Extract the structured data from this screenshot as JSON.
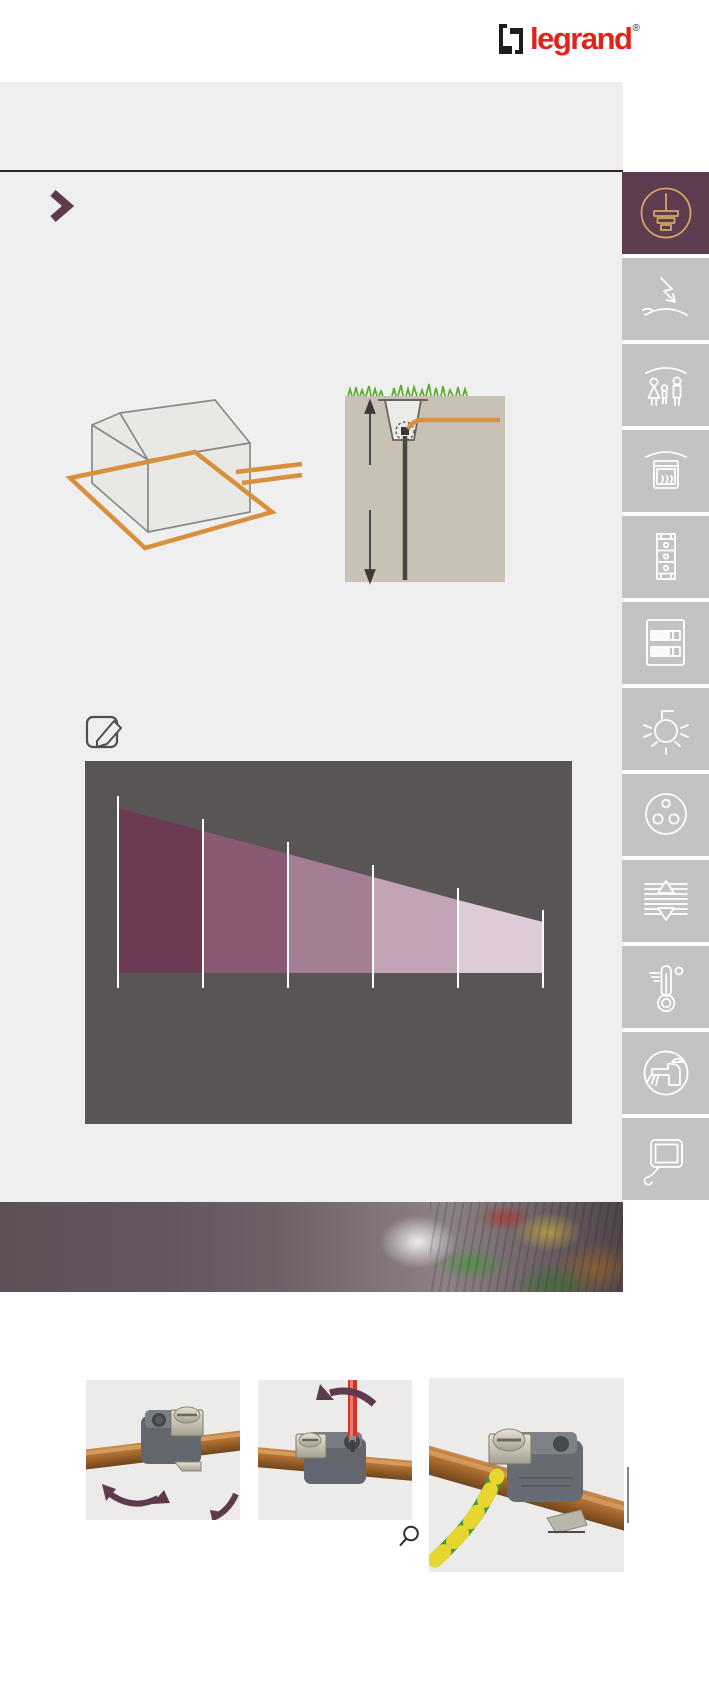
{
  "header": {
    "logo_text": "legrand",
    "registered_mark": "®",
    "brand_red": "#e2231a",
    "logo_mark_color": "#1d1d1b"
  },
  "layout_colors": {
    "page_background": "#ffffff",
    "content_background": "#efefef",
    "rule_color": "#2b242b",
    "section_chevron_color": "#5e3a4d"
  },
  "sidebar": {
    "active_index": 0,
    "active_tile_color": "#5c3c4e",
    "active_icon_color": "#d4a567",
    "tile_color": "#c3c3c3",
    "icon_color": "#ffffff",
    "items": [
      {
        "icon": "earth-ground-icon"
      },
      {
        "icon": "lightning-surge-icon"
      },
      {
        "icon": "family-protection-icon"
      },
      {
        "icon": "oven-cooking-icon"
      },
      {
        "icon": "distribution-column-icon"
      },
      {
        "icon": "consumer-unit-icon"
      },
      {
        "icon": "energy-saving-lamp-icon"
      },
      {
        "icon": "power-socket-icon"
      },
      {
        "icon": "roller-shutter-icon"
      },
      {
        "icon": "thermometer-icon"
      },
      {
        "icon": "water-tap-icon"
      },
      {
        "icon": "monitor-icon"
      }
    ]
  },
  "illustrations": {
    "house_earth_loop": {
      "loop_color": "#d8903f",
      "house_outline_color": "#8a8a8a",
      "house_fill_color": "#e9e8e4"
    },
    "earth_rod_trench": {
      "soil_color": "#c8c1b6",
      "grass_color": "#5aac2e",
      "conductor_color": "#d8903f",
      "rod_color": "#4c4543",
      "arrow_color": "#3c3a38"
    },
    "notes_icon": "pencil-edit-icon"
  },
  "chart_data": {
    "type": "area",
    "title": "",
    "xlabel": "",
    "ylabel": "",
    "x": [
      0,
      1,
      2,
      3,
      4,
      5
    ],
    "values": [
      165,
      142,
      119,
      96,
      73,
      51
    ],
    "values_note": "decreasing wedge height (px) at each white divider, linear slope",
    "segment_colors": [
      "#6d3a53",
      "#8a5a72",
      "#a37e94",
      "#c1a4b5",
      "#decbd8"
    ],
    "divider_color": "#ffffff",
    "background": "#595557",
    "panel": {
      "x": 85,
      "y": 761,
      "width": 487,
      "height": 363
    },
    "divider_x": [
      33,
      118,
      203,
      288,
      373,
      458
    ],
    "baseline_y": 212,
    "tick_overhang_top": 12,
    "tick_bottom_y": 227,
    "grid": false,
    "legend": false
  },
  "photo_strip": {
    "content": "blurred photo of earthing terminal strip with green-yellow wires, purple gradient overlay",
    "base_colors": [
      "#5d5057",
      "#8d8285"
    ]
  },
  "gallery": {
    "photos": [
      {
        "name": "step-1-clip-clamp-on-rod",
        "arrow_color": "#5e3a4d"
      },
      {
        "name": "step-2-tighten-with-screwdriver",
        "arrow_color": "#5e3a4d",
        "screwdriver_color": "#d0352c"
      },
      {
        "name": "step-3-earth-wire-connected",
        "wire_colors": [
          "#3e9c33",
          "#e6d62f"
        ]
      }
    ]
  },
  "footer": {
    "zoom_icon": "magnifier-icon"
  }
}
